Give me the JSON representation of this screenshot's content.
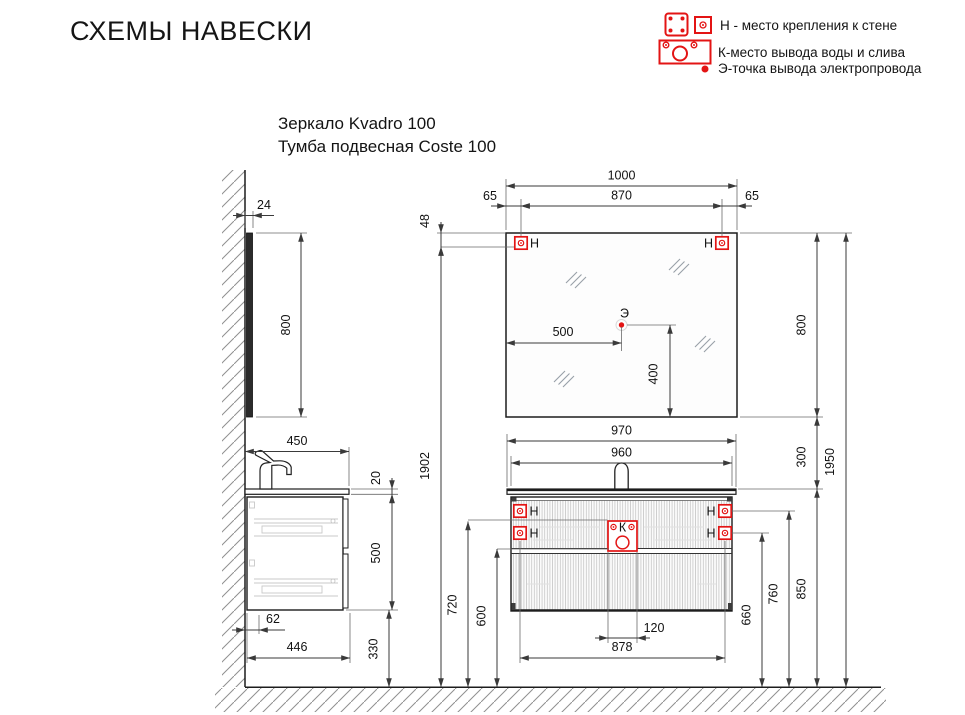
{
  "title": "СХЕМЫ НАВЕСКИ",
  "subtitle": {
    "line1": "Зеркало Kvadro 100",
    "line2": "Тумба подвесная Coste 100"
  },
  "legend": {
    "wall_mount": "Н - место крепления к стене",
    "water_drain": "К-место вывода воды и слива",
    "electric": "Э-точка вывода электропровода"
  },
  "markers": {
    "mount": "Н",
    "water": "К",
    "electric": "Э"
  },
  "colors": {
    "accent_red": "#e31414",
    "line": "#1d1d1d",
    "dim_line": "#3a3a3a"
  },
  "dims": {
    "mirror_width": "1000",
    "mirror_mount_span": "870",
    "mirror_mount_offset_left": "65",
    "mirror_mount_offset_right": "65",
    "mirror_mount_from_top": "48",
    "mirror_height": "800",
    "mirror_height_side": "800",
    "mirror_depth": "24",
    "electric_from_left": "500",
    "electric_from_bottom": "400",
    "vanity_top_width": "970",
    "vanity_body_width": "960",
    "vanity_depth": "450",
    "countertop_thickness": "20",
    "vanity_height": "500",
    "wall_gap": "62",
    "vanity_bottom_depth": "446",
    "floor_to_vanity_bottom": "330",
    "vanity_mount_span": "878",
    "drain_offset": "120",
    "floor_to_drain": "600",
    "floor_to_water": "720",
    "floor_to_mount_low": "660",
    "floor_to_mount_high": "760",
    "floor_to_countertop": "850",
    "mirror_gap": "300",
    "floor_to_mirror_mount": "1902",
    "floor_to_mirror_top": "1950"
  }
}
